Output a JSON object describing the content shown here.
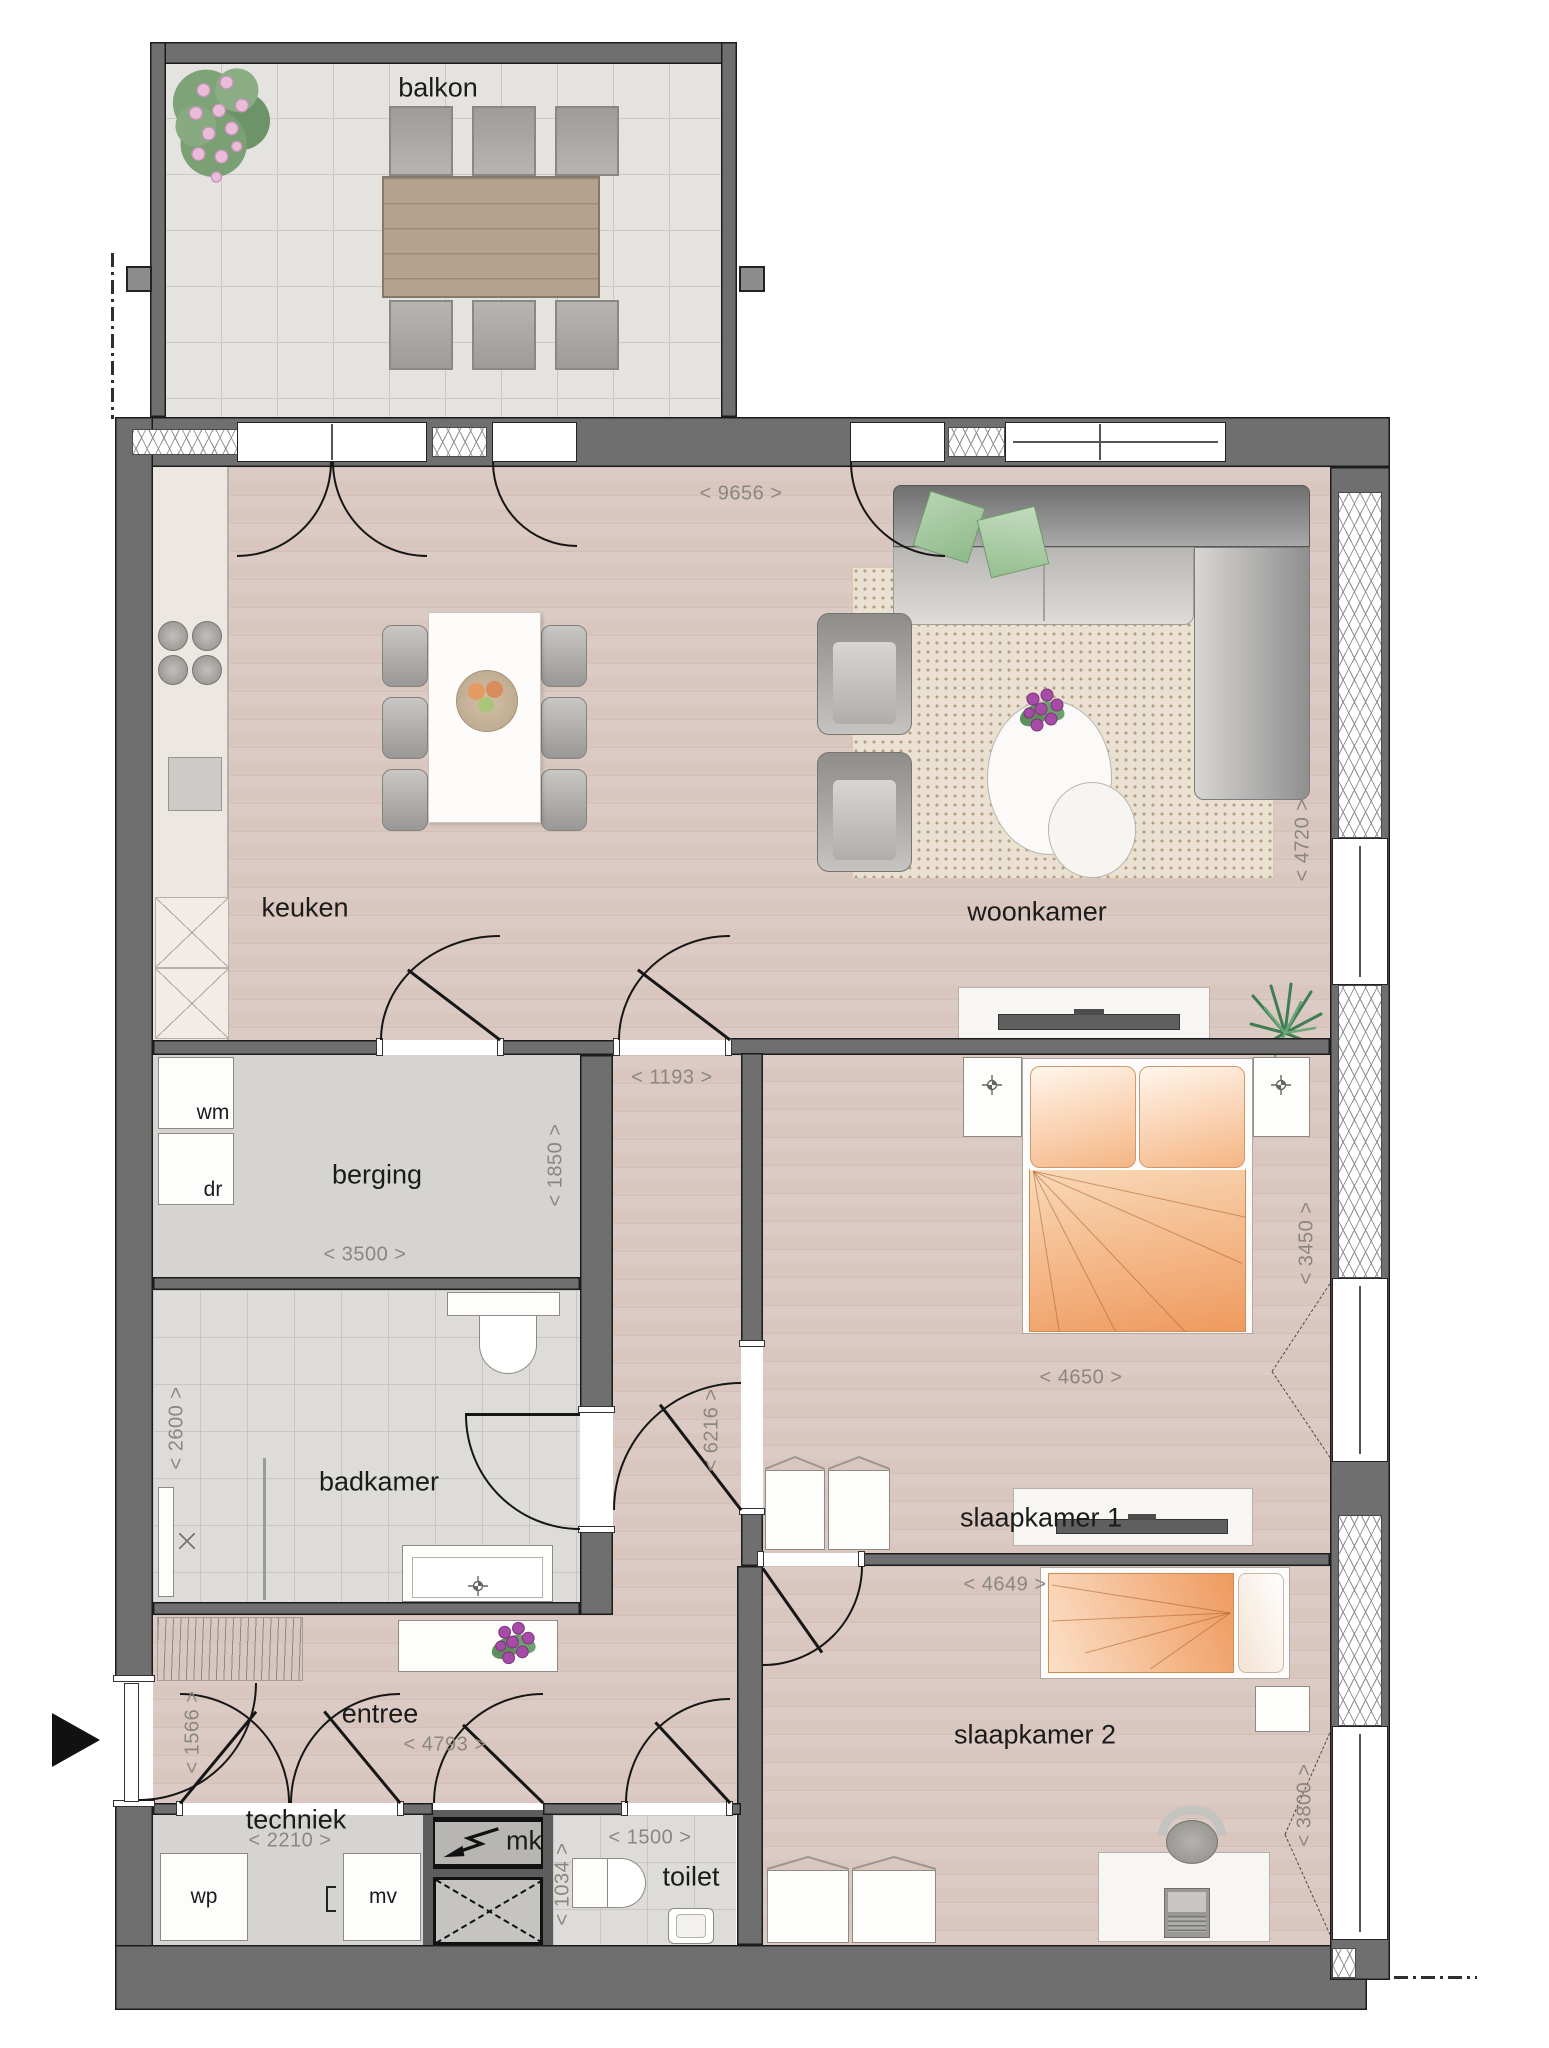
{
  "labels": {
    "balkon": "balkon",
    "keuken": "keuken",
    "woonkamer": "woonkamer",
    "berging": "berging",
    "badkamer": "badkamer",
    "slaapkamer1": "slaapkamer 1",
    "slaapkamer2": "slaapkamer 2",
    "entree": "entree",
    "techniek": "techniek",
    "toilet": "toilet",
    "wm": "wm",
    "dr": "dr",
    "wp": "wp",
    "mv": "mv",
    "mk": "mk"
  },
  "dimensions": {
    "living_width": "< 9656 >",
    "living_depth": "< 4720 >",
    "hall_width": "< 1193 >",
    "berging_depth": "< 1850 >",
    "berging_width": "< 3500 >",
    "badkamer_depth": "< 2600 >",
    "corridor_depth": "< 6216 >",
    "slaapkamer1_width": "< 4650 >",
    "slaapkamer1_depth": "< 3450 >",
    "slaapkamer2_width": "< 4649 >",
    "slaapkamer2_depth": "< 3800 >",
    "entree_depth": "< 1566 >",
    "entree_width": "< 4793 >",
    "techniek_width": "< 2210 >",
    "toilet_depth": "< 1034 >",
    "toilet_width": "< 1500 >"
  },
  "colors": {
    "wall": "#6f6f6f",
    "wood_floor": "#d9c7bf",
    "tile_floor": "#dedcd9",
    "bedding_orange": "#ef9a5e",
    "dimension_text": "#8b8681"
  }
}
